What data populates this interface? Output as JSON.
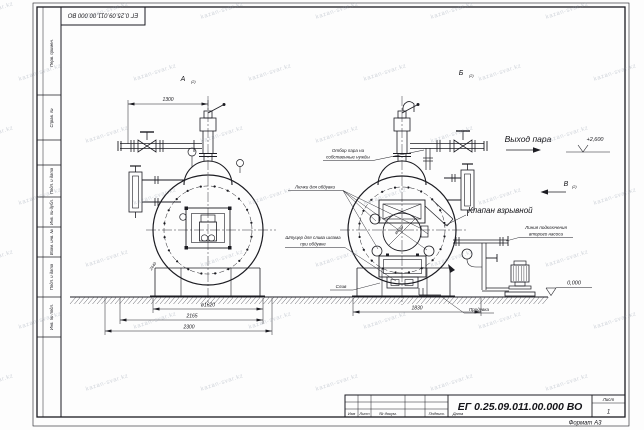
{
  "watermark": {
    "text": "kazan-svar.kz"
  },
  "frame": {
    "designation": "ЕГ 0.25.09.011.00.000  ВО",
    "left_strip": [
      "Перв. примен.",
      "Справ. №",
      "Подп. и дата",
      "Инв. № дубл.",
      "Взам. инв. №",
      "Подп. и дата",
      "Инв. № подл."
    ]
  },
  "views": {
    "view_a_label": "А",
    "view_a_ref": "(2)",
    "view_b_label": "Б",
    "view_b_ref": "(2)",
    "arrow_v_label": "В",
    "arrow_v_ref": "(2)"
  },
  "labels": {
    "steam_outlet": "Выход пара",
    "steam_own_needs_1": "Отбор пара на",
    "steam_own_needs_2": "собственные нужды",
    "blow_hatches": "Лючки для обдувки",
    "sludge_1": "Штуцер для слива шлама",
    "sludge_2": "при обдувке",
    "explosion_valve": "Клапан взрывной",
    "second_pump_1": "Линия подключения",
    "second_pump_2": "второго насоса",
    "drain": "Слив",
    "blowdown": "Продувка"
  },
  "levels": {
    "top": "+2,600",
    "ground": "0,000"
  },
  "dimensions": {
    "d1300": "1300",
    "d1620": "ø1620",
    "d2165": "2165",
    "d2300": "2300",
    "d1830": "1830",
    "d450": "ø450",
    "d2440": "2440"
  },
  "title_block": {
    "designation": "ЕГ 0.25.09.011.00.000  ВО",
    "cols": [
      "Изм",
      "Лист",
      "№ докум.",
      "Подпись",
      "Дата"
    ],
    "sheet_label": "Лист",
    "sheet_value": "1",
    "format": "Формат А3"
  }
}
